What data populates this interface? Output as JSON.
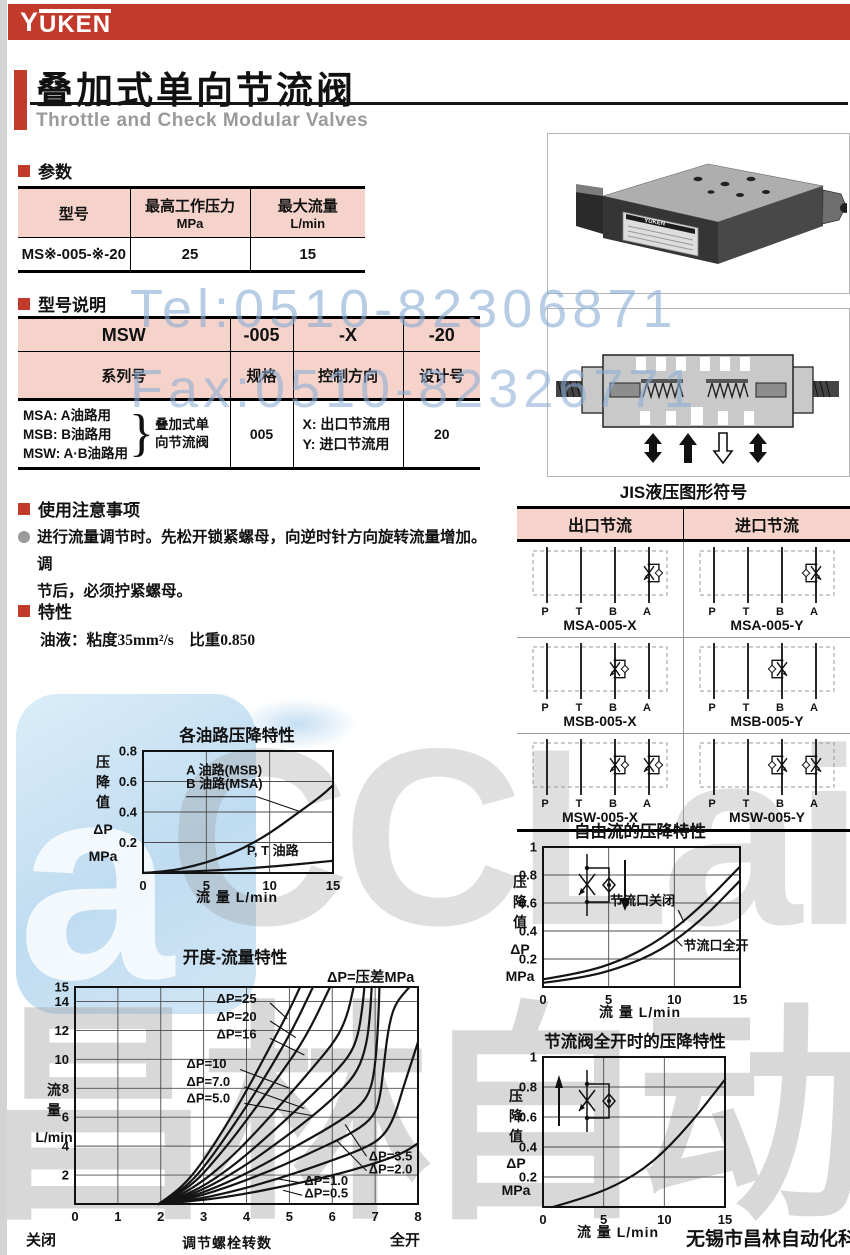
{
  "brand": {
    "logo_y": "Y",
    "logo_rest": "UKEN"
  },
  "header": {
    "title": "叠加式单向节流阀",
    "subtitle": "Throttle and Check Modular Valves"
  },
  "watermarks": {
    "tel": "Tel:0510-82306871",
    "fax": "Fax:0510-82326771",
    "cclair": "CCLair",
    "company_gray": "昌林自动化",
    "blue_a": "a"
  },
  "footer": {
    "company": "无锡市昌林自动化科技"
  },
  "sections": {
    "params": {
      "heading": "参数",
      "table": {
        "col1_header": "型号",
        "col2_header": "最高工作压力",
        "col2_unit": "MPa",
        "col3_header": "最大流量",
        "col3_unit": "L/min",
        "row": {
          "model": "MS※-005-※-20",
          "pressure": "25",
          "flow": "15"
        }
      }
    },
    "model": {
      "heading": "型号说明",
      "table": {
        "r1": [
          "MSW",
          "-005",
          "-X",
          "-20"
        ],
        "r2": [
          "系列号",
          "规格",
          "控制方向",
          "设计号"
        ],
        "series_lines": [
          "MSA: A油路用",
          "MSB: B油路用",
          "MSW: A·B油路用"
        ],
        "brace": "}",
        "series_group": [
          "叠加式单",
          "向节流阀"
        ],
        "spec": "005",
        "dir_lines": [
          "X: 出口节流用",
          "Y: 进口节流用"
        ],
        "design": "20"
      }
    },
    "notes": {
      "heading": "使用注意事项",
      "lines": [
        "进行流量调节时。先松开锁紧螺母，向逆时针方向旋转流量增加。调",
        "节后，必须拧紧螺母。"
      ]
    },
    "features": {
      "heading": "特性",
      "text": "油液：粘度35mm²/s　比重0.850"
    },
    "photo": {
      "label": "YUKEN"
    },
    "jis": {
      "title": "JIS液压图形符号",
      "columns": [
        "出口节流",
        "进口节流"
      ],
      "ports": [
        "P",
        "T",
        "B",
        "A"
      ],
      "cells": [
        [
          {
            "label": "MSA-005-X",
            "lines": [
              3
            ],
            "variant": "X"
          },
          {
            "label": "MSA-005-Y",
            "lines": [
              3
            ],
            "variant": "Y"
          }
        ],
        [
          {
            "label": "MSB-005-X",
            "lines": [
              2
            ],
            "variant": "X"
          },
          {
            "label": "MSB-005-Y",
            "lines": [
              2
            ],
            "variant": "Y"
          }
        ],
        [
          {
            "label": "MSW-005-X",
            "lines": [
              2,
              3
            ],
            "variant": "X"
          },
          {
            "label": "MSW-005-Y",
            "lines": [
              2,
              3
            ],
            "variant": "Y"
          }
        ]
      ]
    }
  },
  "chart_data": [
    {
      "type": "line",
      "title": "各油路压降特性",
      "xlabel": "流 量  L/min",
      "ylabel_lines": [
        "压",
        "降",
        "值",
        "ΔP",
        "MPa"
      ],
      "xlim": [
        0,
        15
      ],
      "ylim": [
        0,
        0.8
      ],
      "xticks": [
        0,
        5,
        10,
        15
      ],
      "yticks": [
        0.2,
        0.4,
        0.6,
        0.8
      ],
      "grid_x": [
        5,
        10
      ],
      "grid_y": [
        0.2,
        0.4,
        0.6,
        0.8
      ],
      "series": [
        {
          "name": "A油路(MSB)/B油路(MSA)",
          "points": [
            [
              0,
              0
            ],
            [
              2,
              0.012
            ],
            [
              4,
              0.045
            ],
            [
              6,
              0.095
            ],
            [
              8,
              0.165
            ],
            [
              10,
              0.26
            ],
            [
              12,
              0.38
            ],
            [
              14,
              0.5
            ],
            [
              15,
              0.575
            ]
          ]
        },
        {
          "name": "P,T油路",
          "points": [
            [
              0,
              0
            ],
            [
              5,
              0.012
            ],
            [
              10,
              0.04
            ],
            [
              15,
              0.08
            ]
          ]
        }
      ],
      "labels": [
        {
          "text": "A 油路(MSB)",
          "x": 3.4,
          "y": 0.645
        },
        {
          "text": "B 油路(MSA)",
          "x": 3.4,
          "y": 0.558
        },
        {
          "text": "P, T 油路",
          "x": 8.2,
          "y": 0.118
        }
      ],
      "leaders": [
        [
          3.4,
          0.5,
          9.0,
          0.5
        ],
        [
          9.0,
          0.5,
          12.5,
          0.4
        ]
      ]
    },
    {
      "type": "line",
      "title": "开度-流量特性",
      "xlabel": "调节螺栓转数",
      "ylabel_lines": [
        "流",
        "量",
        "L/min"
      ],
      "annotation": "ΔP=压差MPa",
      "x_left_label": "关闭",
      "x_right_label": "全开",
      "xlim": [
        0,
        8
      ],
      "ylim": [
        0,
        15
      ],
      "xticks": [
        0,
        1,
        2,
        3,
        4,
        5,
        6,
        7,
        8
      ],
      "yticks": [
        2,
        4,
        6,
        8,
        10,
        12,
        14,
        15
      ],
      "grid_x": [
        1,
        2,
        3,
        4,
        5,
        6,
        7
      ],
      "grid_y": [
        2,
        4,
        6,
        8,
        10,
        12,
        14
      ],
      "series": [
        {
          "name": "ΔP=25",
          "points": [
            [
              1.95,
              0
            ],
            [
              2.2,
              0.5
            ],
            [
              2.6,
              1.5
            ],
            [
              3.0,
              3.0
            ],
            [
              3.5,
              5.3
            ],
            [
              4.0,
              7.8
            ],
            [
              4.5,
              10.6
            ],
            [
              5.0,
              13.4
            ],
            [
              5.25,
              15
            ]
          ]
        },
        {
          "name": "ΔP=20",
          "points": [
            [
              1.95,
              0
            ],
            [
              2.25,
              0.5
            ],
            [
              2.7,
              1.5
            ],
            [
              3.1,
              2.9
            ],
            [
              3.6,
              5.0
            ],
            [
              4.1,
              7.2
            ],
            [
              4.6,
              9.6
            ],
            [
              5.1,
              12.2
            ],
            [
              5.55,
              15
            ]
          ]
        },
        {
          "name": "ΔP=16",
          "points": [
            [
              1.95,
              0
            ],
            [
              2.3,
              0.5
            ],
            [
              2.8,
              1.5
            ],
            [
              3.2,
              2.8
            ],
            [
              3.7,
              4.6
            ],
            [
              4.2,
              6.6
            ],
            [
              4.8,
              9.0
            ],
            [
              5.4,
              11.6
            ],
            [
              5.95,
              15
            ]
          ]
        },
        {
          "name": "ΔP=10",
          "points": [
            [
              1.95,
              0
            ],
            [
              2.4,
              0.5
            ],
            [
              3.0,
              1.6
            ],
            [
              3.6,
              3.1
            ],
            [
              4.2,
              4.9
            ],
            [
              4.9,
              7.2
            ],
            [
              5.6,
              9.6
            ],
            [
              6.1,
              11.4
            ],
            [
              6.35,
              13.0
            ],
            [
              6.5,
              15
            ]
          ]
        },
        {
          "name": "ΔP=7.0",
          "points": [
            [
              1.95,
              0
            ],
            [
              2.45,
              0.45
            ],
            [
              3.1,
              1.4
            ],
            [
              3.8,
              2.9
            ],
            [
              4.5,
              4.7
            ],
            [
              5.2,
              6.6
            ],
            [
              5.9,
              8.6
            ],
            [
              6.4,
              10.2
            ],
            [
              6.6,
              11.6
            ],
            [
              6.7,
              13.5
            ],
            [
              6.75,
              15
            ]
          ]
        },
        {
          "name": "ΔP=5.0",
          "points": [
            [
              1.95,
              0
            ],
            [
              2.5,
              0.4
            ],
            [
              3.2,
              1.3
            ],
            [
              4.0,
              2.7
            ],
            [
              4.8,
              4.4
            ],
            [
              5.6,
              6.2
            ],
            [
              6.2,
              7.8
            ],
            [
              6.6,
              9.2
            ],
            [
              6.8,
              11.0
            ],
            [
              6.88,
              13.0
            ],
            [
              6.92,
              15
            ]
          ]
        },
        {
          "name": "ΔP=3.5",
          "points": [
            [
              1.95,
              0
            ],
            [
              2.55,
              0.35
            ],
            [
              3.3,
              1.15
            ],
            [
              4.2,
              2.4
            ],
            [
              5.1,
              3.9
            ],
            [
              6.0,
              5.4
            ],
            [
              6.6,
              6.6
            ],
            [
              6.9,
              7.8
            ],
            [
              7.02,
              10.0
            ],
            [
              7.08,
              13.0
            ],
            [
              7.1,
              15
            ]
          ]
        },
        {
          "name": "ΔP=2.0",
          "points": [
            [
              1.95,
              0
            ],
            [
              2.6,
              0.3
            ],
            [
              3.4,
              1.0
            ],
            [
              4.4,
              2.1
            ],
            [
              5.4,
              3.4
            ],
            [
              6.4,
              4.8
            ],
            [
              6.9,
              5.8
            ],
            [
              7.1,
              7.0
            ],
            [
              7.2,
              9.5
            ],
            [
              7.3,
              12.0
            ],
            [
              7.45,
              13.8
            ],
            [
              7.8,
              15
            ]
          ]
        },
        {
          "name": "ΔP=1.0",
          "points": [
            [
              1.95,
              0
            ],
            [
              2.7,
              0.25
            ],
            [
              3.6,
              0.8
            ],
            [
              4.7,
              1.7
            ],
            [
              5.8,
              2.8
            ],
            [
              6.8,
              3.9
            ],
            [
              7.2,
              4.7
            ],
            [
              7.45,
              6.0
            ],
            [
              7.65,
              8.0
            ],
            [
              7.85,
              9.8
            ],
            [
              8,
              11.2
            ]
          ]
        },
        {
          "name": "ΔP=0.5",
          "points": [
            [
              1.95,
              0
            ],
            [
              2.8,
              0.2
            ],
            [
              3.8,
              0.6
            ],
            [
              5.0,
              1.3
            ],
            [
              6.2,
              2.1
            ],
            [
              7.2,
              3.0
            ],
            [
              7.7,
              3.6
            ],
            [
              8,
              4.2
            ]
          ]
        }
      ],
      "labels": [
        {
          "text": "ΔP=25",
          "x": 3.3,
          "y": 13.9
        },
        {
          "text": "ΔP=20",
          "x": 3.3,
          "y": 12.65
        },
        {
          "text": "ΔP=16",
          "x": 3.3,
          "y": 11.45
        },
        {
          "text": "ΔP=10",
          "x": 2.6,
          "y": 9.4
        },
        {
          "text": "ΔP=7.0",
          "x": 2.6,
          "y": 8.15
        },
        {
          "text": "ΔP=5.0",
          "x": 2.6,
          "y": 7.0
        },
        {
          "text": "ΔP=3.5",
          "x": 6.85,
          "y": 3.0
        },
        {
          "text": "ΔP=2.0",
          "x": 6.85,
          "y": 2.1
        },
        {
          "text": "ΔP=1.0",
          "x": 5.35,
          "y": 1.3
        },
        {
          "text": "ΔP=0.5",
          "x": 5.35,
          "y": 0.45
        }
      ],
      "leaders": [
        [
          4.55,
          13.9,
          4.95,
          12.8
        ],
        [
          4.55,
          12.65,
          5.15,
          11.5
        ],
        [
          4.55,
          11.45,
          5.35,
          10.3
        ],
        [
          3.85,
          9.3,
          5.0,
          8.0
        ],
        [
          3.95,
          8.1,
          5.35,
          6.6
        ],
        [
          3.95,
          6.95,
          5.55,
          6.1
        ],
        [
          6.8,
          3.3,
          6.3,
          5.5
        ],
        [
          6.8,
          2.3,
          6.1,
          4.4
        ],
        [
          5.3,
          1.45,
          4.7,
          1.75
        ],
        [
          5.3,
          0.6,
          4.85,
          0.95
        ]
      ]
    },
    {
      "type": "line",
      "title": "自由流的压降特性",
      "xlabel": "流 量  L/min",
      "ylabel_lines": [
        "压",
        "降",
        "值",
        "ΔP",
        "MPa"
      ],
      "xlim": [
        0,
        15
      ],
      "ylim": [
        0,
        1.0
      ],
      "xticks": [
        0,
        5,
        10,
        15
      ],
      "yticks": [
        0.2,
        0.4,
        0.6,
        0.8,
        1.0
      ],
      "grid_x": [
        5,
        10
      ],
      "grid_y": [
        0.2,
        0.4,
        0.6,
        0.8
      ],
      "series": [
        {
          "name": "节流口关闭",
          "points": [
            [
              0,
              0.055
            ],
            [
              3,
              0.1
            ],
            [
              6,
              0.19
            ],
            [
              9,
              0.34
            ],
            [
              12,
              0.57
            ],
            [
              15,
              0.86
            ]
          ]
        },
        {
          "name": "节流口全开",
          "points": [
            [
              0,
              0.03
            ],
            [
              3,
              0.065
            ],
            [
              6,
              0.14
            ],
            [
              9,
              0.26
            ],
            [
              12,
              0.47
            ],
            [
              15,
              0.76
            ]
          ]
        }
      ],
      "labels": [
        {
          "text": "节流口关闭",
          "x": 5.1,
          "y": 0.585
        },
        {
          "text": "节流口全开",
          "x": 10.7,
          "y": 0.265
        }
      ],
      "leaders": [
        [
          10.3,
          0.55,
          10.75,
          0.46
        ],
        [
          10.6,
          0.29,
          10.15,
          0.335
        ]
      ],
      "inset": {
        "dir": "down",
        "px": 61,
        "py": 21
      }
    },
    {
      "type": "line",
      "title": "节流阀全开时的压降特性",
      "xlabel": "流 量  L/min",
      "ylabel_lines": [
        "压",
        "降",
        "值",
        "ΔP",
        "MPa"
      ],
      "xlim": [
        0,
        15
      ],
      "ylim": [
        0,
        1.0
      ],
      "xticks": [
        0,
        5,
        10,
        15
      ],
      "yticks": [
        0.2,
        0.4,
        0.6,
        0.8,
        1.0
      ],
      "grid_x": [
        5,
        10
      ],
      "grid_y": [
        0.2,
        0.4,
        0.6,
        0.8
      ],
      "series": [
        {
          "name": "节流阀全开",
          "points": [
            [
              0.8,
              0
            ],
            [
              3,
              0.05
            ],
            [
              6,
              0.14
            ],
            [
              9,
              0.29
            ],
            [
              12,
              0.54
            ],
            [
              15,
              0.85
            ]
          ]
        }
      ],
      "labels": [],
      "leaders": [],
      "inset": {
        "dir": "up",
        "px": 47,
        "py": 27
      }
    }
  ]
}
